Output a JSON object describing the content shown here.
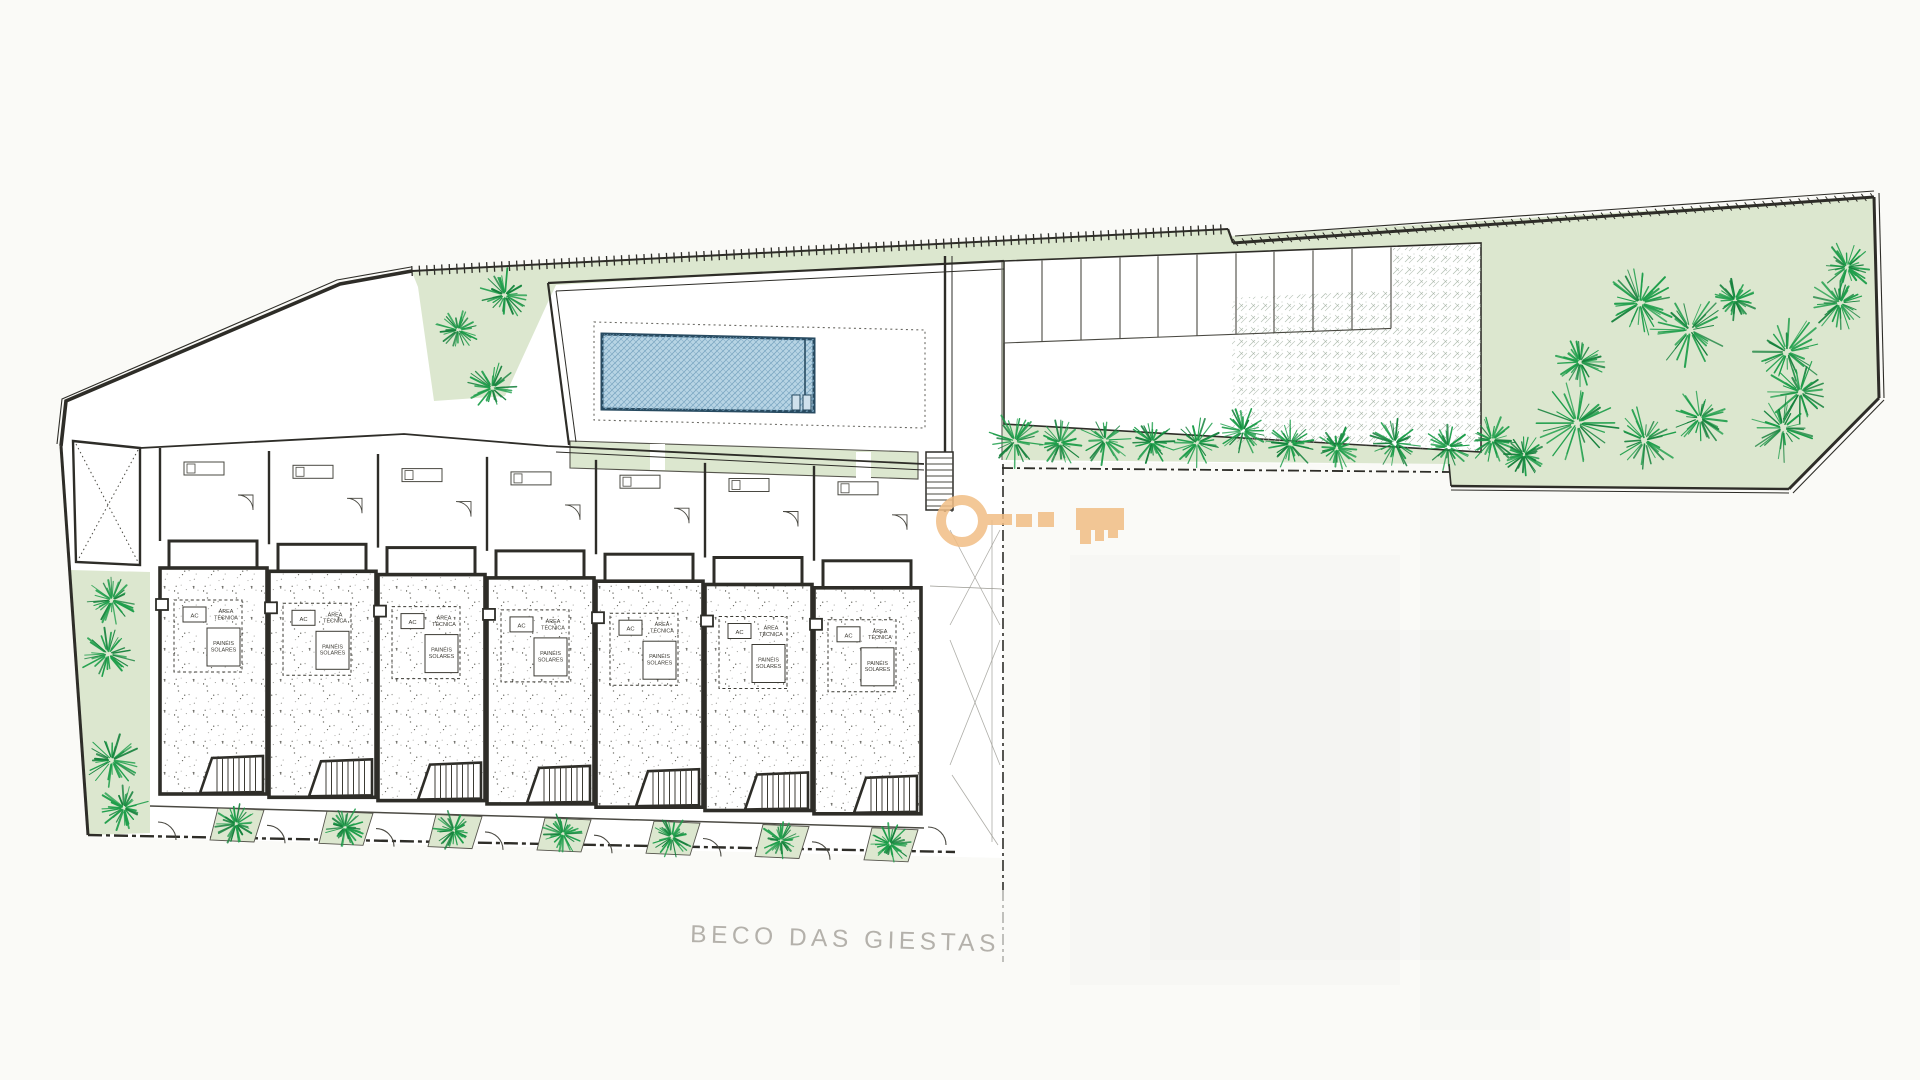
{
  "plan": {
    "street_label": "BECO DAS GIESTAS",
    "units": {
      "count": 7,
      "labels": {
        "ac": "AC",
        "area_tecnica": [
          "ÁREA",
          "TÉCNICA"
        ],
        "paineis_solares": [
          "PAINÉIS",
          "SOLARES"
        ]
      }
    },
    "icons": {
      "tree": "tree-icon",
      "watermark": "key-watermark",
      "fence": "boundary-fence-icon",
      "pool": "swimming-pool",
      "stairs": "stairs-icon",
      "gate": "gate-swing-icon",
      "parking": "parking-stalls"
    },
    "colors": {
      "paper": "#fafaf7",
      "site_fill": "#ffffff",
      "green": "#dce7cf",
      "green_edge": "#9aaa87",
      "tree": "#1d9e4a",
      "tree_dark": "#15813c",
      "pool_fill": "#b7d4e4",
      "pool_hatch": "#7ba6c1",
      "pool_border": "#274a60",
      "ink": "#2e2d28",
      "ink_light": "#6b6a64",
      "street_text": "#b4b1ab",
      "watermark": "#f1be85",
      "crosshatch": "#9ead9c",
      "stipple": "#45443c"
    }
  }
}
